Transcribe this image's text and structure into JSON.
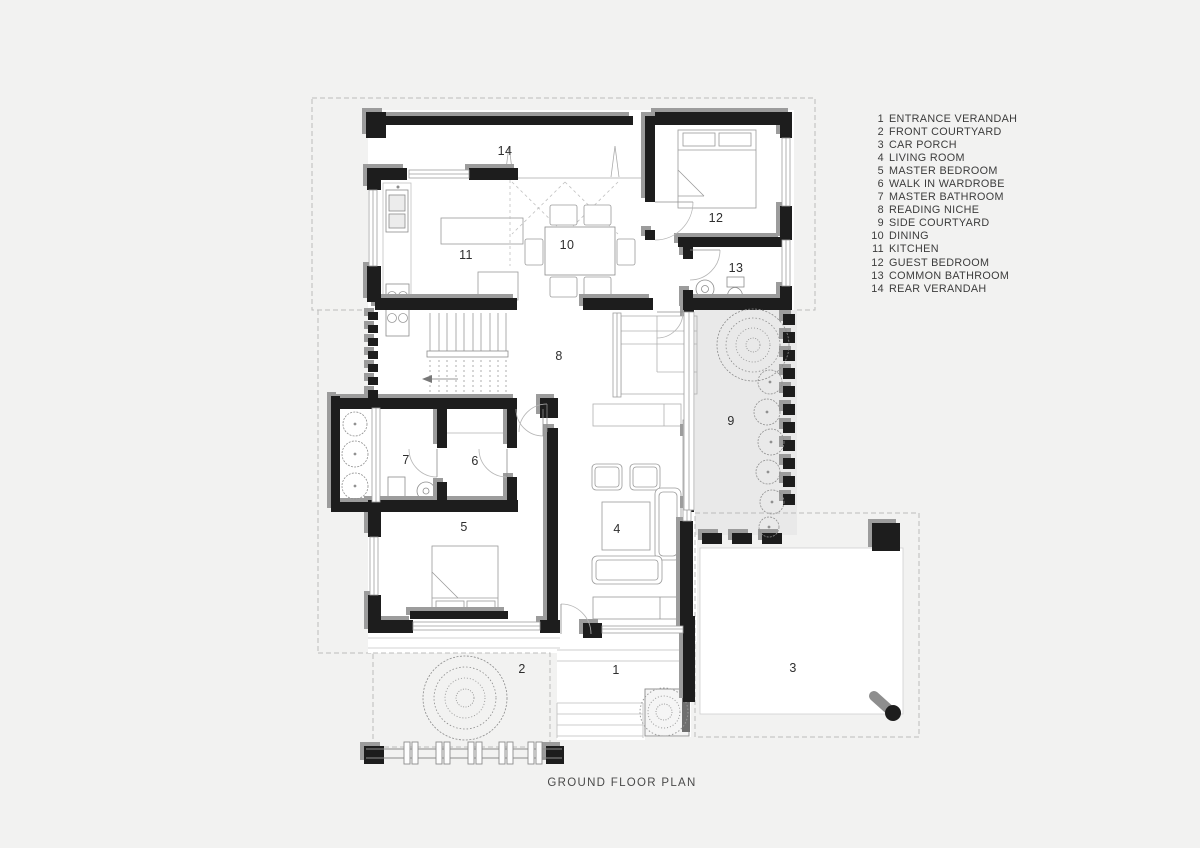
{
  "page_title": "GROUND FLOOR PLAN",
  "rooms": [
    {
      "num": "1",
      "label": "ENTRANCE VERANDAH"
    },
    {
      "num": "2",
      "label": "FRONT COURTYARD"
    },
    {
      "num": "3",
      "label": "CAR PORCH"
    },
    {
      "num": "4",
      "label": "LIVING ROOM"
    },
    {
      "num": "5",
      "label": "MASTER BEDROOM"
    },
    {
      "num": "6",
      "label": "WALK IN WARDROBE"
    },
    {
      "num": "7",
      "label": "MASTER BATHROOM"
    },
    {
      "num": "8",
      "label": "READING NICHE"
    },
    {
      "num": "9",
      "label": "SIDE COURTYARD"
    },
    {
      "num": "10",
      "label": "DINING"
    },
    {
      "num": "11",
      "label": "KITCHEN"
    },
    {
      "num": "12",
      "label": "GUEST BEDROOM"
    },
    {
      "num": "13",
      "label": "COMMON BATHROOM"
    },
    {
      "num": "14",
      "label": "REAR VERANDAH"
    }
  ],
  "colors": {
    "background": "#f2f2f1",
    "wall": "#1d1d1d",
    "wall_shadow": "#9c9c9c",
    "courtyard_fill": "#e9e9e9",
    "furniture_line": "#a0a0a0",
    "boundary_dash": "#bcbcbc",
    "text": "#3c3c3c"
  }
}
